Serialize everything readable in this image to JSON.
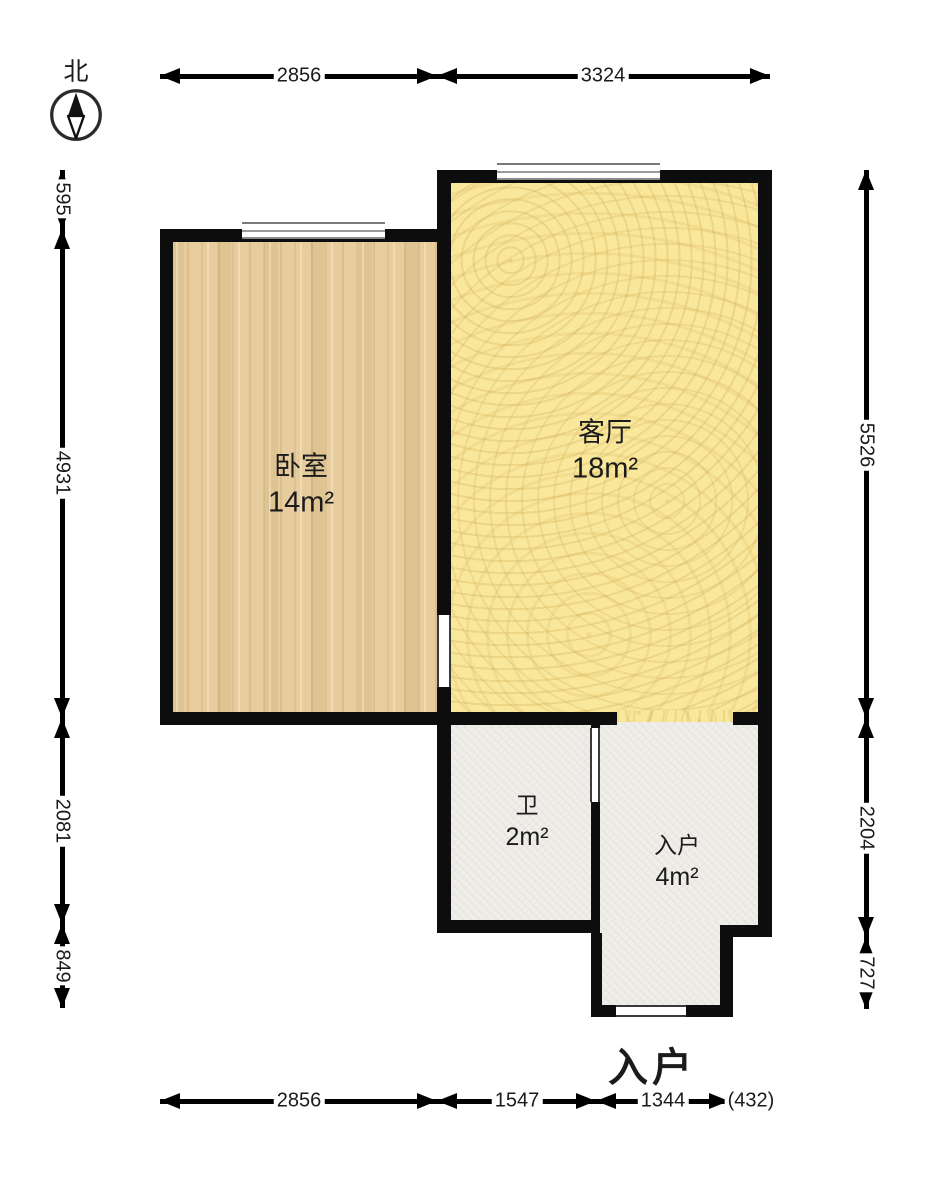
{
  "compass": {
    "north_label": "北"
  },
  "rooms": {
    "bedroom": {
      "name": "卧室",
      "area": "14m²"
    },
    "living": {
      "name": "客厅",
      "area": "18m²"
    },
    "bath": {
      "name": "卫",
      "area": "2m²"
    },
    "entry": {
      "name": "入户",
      "area": "4m²"
    }
  },
  "entrance_label": "入户",
  "dims": {
    "top": [
      "2856",
      "3324"
    ],
    "bottom": [
      "2856",
      "1547",
      "1344",
      "(432)"
    ],
    "left": [
      "595",
      "4931",
      "2081",
      "849"
    ],
    "right": [
      "5526",
      "2204",
      "727"
    ]
  },
  "colors": {
    "wall": "#0d0d0d",
    "bedroom_floor": "#e7cd9d",
    "living_floor": "#f9e79b",
    "hall_floor": "#f0eee9",
    "window_line": "#7a7a7a"
  }
}
